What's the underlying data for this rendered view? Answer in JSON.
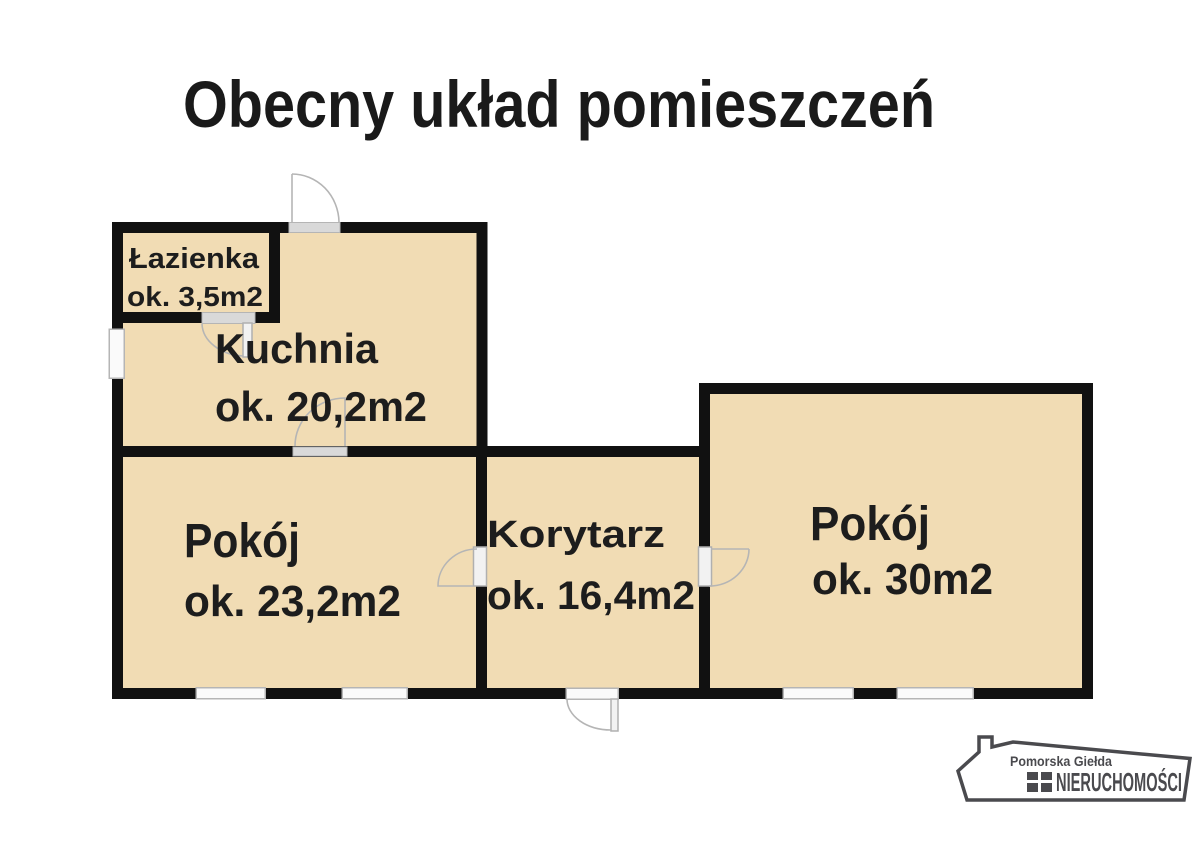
{
  "title": "Obecny układ pomieszczeń",
  "floorplan": {
    "rooms": [
      {
        "id": "bathroom",
        "name": "Łazienka",
        "area": "ok. 3,5m2"
      },
      {
        "id": "kitchen",
        "name": "Kuchnia",
        "area": "ok. 20,2m2"
      },
      {
        "id": "room-left",
        "name": "Pokój",
        "area": "ok. 23,2m2"
      },
      {
        "id": "corridor",
        "name": "Korytarz",
        "area": "ok. 16,4m2"
      },
      {
        "id": "room-right",
        "name": "Pokój",
        "area": "ok. 30m2"
      }
    ],
    "colors": {
      "room_fill": "#f1dcb4",
      "wall": "#111111",
      "door_sill": "#d9d9d9",
      "background": "#ffffff"
    }
  },
  "logo": {
    "line1": "Pomorska Giełda",
    "line2": "NIERUCHOMOŚCI",
    "color": "#4a4a4e"
  }
}
